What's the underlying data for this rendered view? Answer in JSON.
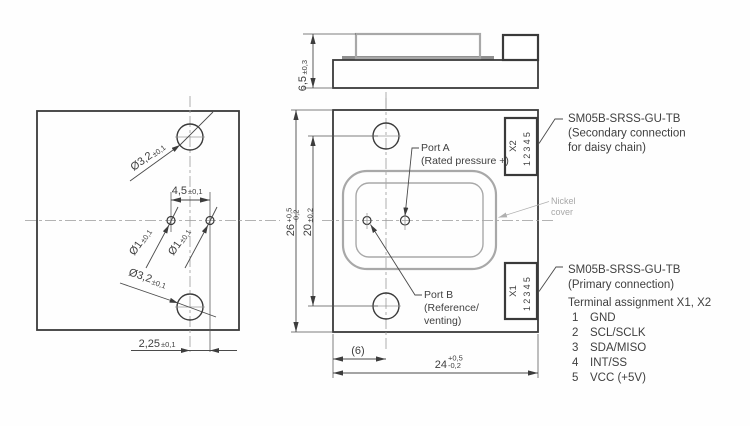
{
  "left_view": {
    "dim_hole_large_top": {
      "value": "Ø3,2",
      "tol": "±0,1"
    },
    "dim_hole_small_left": {
      "value": "Ø1",
      "tol": "±0,1"
    },
    "dim_hole_small_right": {
      "value": "Ø1",
      "tol": "±0,1"
    },
    "dim_hole_large_bottom": {
      "value": "Ø3,2",
      "tol": "±0,1"
    },
    "dim_port_spacing": {
      "value": "4,5",
      "tol": "±0,1"
    },
    "dim_port_offset": {
      "value": "2,25",
      "tol": "±0,1"
    }
  },
  "side_view": {
    "dim_height": {
      "value": "6,5",
      "tol": "±0,3"
    }
  },
  "front_view": {
    "dim_width": {
      "value": "24",
      "tol_plus": "+0,5",
      "tol_minus": "-0,2"
    },
    "dim_height": {
      "value": "26",
      "tol_plus": "+0,5",
      "tol_minus": "-0,2"
    },
    "dim_hole_spacing": {
      "value": "20",
      "tol": "±0,2"
    },
    "dim_ref_offset": "(6)",
    "port_a": {
      "line1": "Port A",
      "line2": "(Rated pressure +)"
    },
    "port_b": {
      "line1": "Port B",
      "line2": "(Reference/",
      "line3": "venting)"
    },
    "connector_x2": {
      "name": "X2",
      "pins": "12345"
    },
    "connector_x1": {
      "name": "X1",
      "pins": "12345"
    },
    "nickel_cover": {
      "line1": "Nickel",
      "line2": "cover"
    }
  },
  "annotations": {
    "secondary_note": {
      "line1": "SM05B-SRSS-GU-TB",
      "line2": "(Secondary connection",
      "line3": "for daisy chain)"
    },
    "primary_note": {
      "line1": "SM05B-SRSS-GU-TB",
      "line2": "(Primary connection)"
    },
    "terminal": {
      "title": "Terminal assignment X1, X2",
      "pins": [
        {
          "num": "1",
          "label": "GND"
        },
        {
          "num": "2",
          "label": "SCL/SCLK"
        },
        {
          "num": "3",
          "label": "SDA/MISO"
        },
        {
          "num": "4",
          "label": "INT/SS"
        },
        {
          "num": "5",
          "label": "VCC (+5V)"
        }
      ]
    }
  },
  "colors": {
    "line": "#3a3a3a",
    "gray": "#a8a8a8",
    "background": "#fefefe"
  }
}
